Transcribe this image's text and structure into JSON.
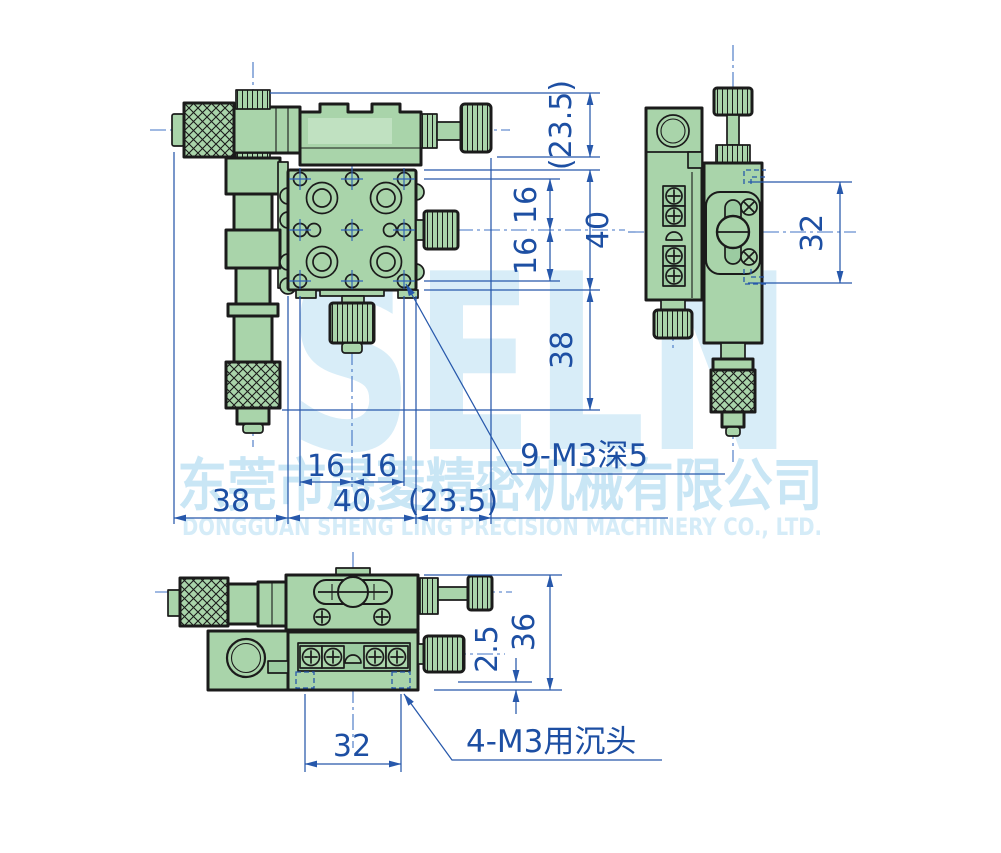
{
  "watermark": {
    "brand": "SELN",
    "company_cn": "东莞市晟菱精密机械有限公司",
    "company_en": "DONGGUAN SHENG LING PRECISION MACHINERY CO., LTD."
  },
  "front_view": {
    "dim_top_offset": "(23.5)",
    "dim_hole_pitch_right_top": "16",
    "dim_hole_pitch_right_bottom": "16",
    "dim_table_height": "40",
    "dim_base_height": "38",
    "dim_hole_pitch_bottom_left": "16",
    "dim_hole_pitch_bottom_right": "16",
    "dim_left_offset": "38",
    "dim_table_width": "40",
    "dim_right_offset": "(23.5)",
    "callout_holes": "9-M3深5"
  },
  "side_view": {
    "dim_body_height": "32"
  },
  "bottom_view": {
    "dim_step": "2.5",
    "dim_total_height": "36",
    "dim_hole_spacing": "32",
    "callout_counterbore": "4-M3用沉头"
  },
  "colors": {
    "body_green": "#a9d4aa",
    "outline": "#1b1b1b",
    "dimension_blue": "#2758ab",
    "dimension_text_blue": "#1d4fa3",
    "centerline_blue": "#4273c4",
    "watermark_blue": "#d7edf9",
    "background": "#ffffff"
  }
}
